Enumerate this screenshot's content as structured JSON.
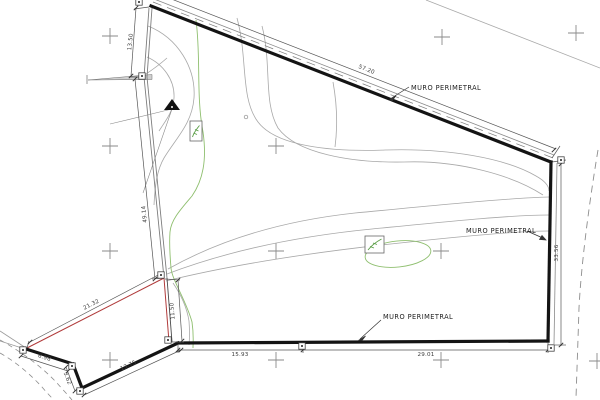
{
  "drawing": {
    "kind": "topographic site plan with perimeter walls",
    "labels": {
      "muro_top": "MURO PERIMETRAL",
      "muro_right": "MURO PERIMETRAL",
      "muro_bottom": "MURO PERIMETRAL"
    },
    "dimensions": {
      "top_edge": "57.20",
      "right_edge": "33.56",
      "left_upper": "13.50",
      "left_middle": "49.14",
      "left_lower": "11.50",
      "red_boundary": "21.32",
      "bottom_left_segment": "15.93",
      "bottom_right_segment": "29.01",
      "sw_wall_a": "6.98",
      "sw_wall_b": "3.62",
      "sw_wall_c": "13.75"
    },
    "symbols": {
      "survey_station": "survey-station-triangle",
      "vegetation_plot_1": "tree-symbol-box",
      "vegetation_plot_2": "tree-symbol-box",
      "grid_marks": "crosshair-grid-marker"
    },
    "colors": {
      "wall": "#141414",
      "contour": "#a8a8a8",
      "vegetation": "#7fb55f",
      "red_line": "#b03a3a",
      "dimension": "#555555",
      "grid_cross": "#8a8a8a"
    }
  }
}
